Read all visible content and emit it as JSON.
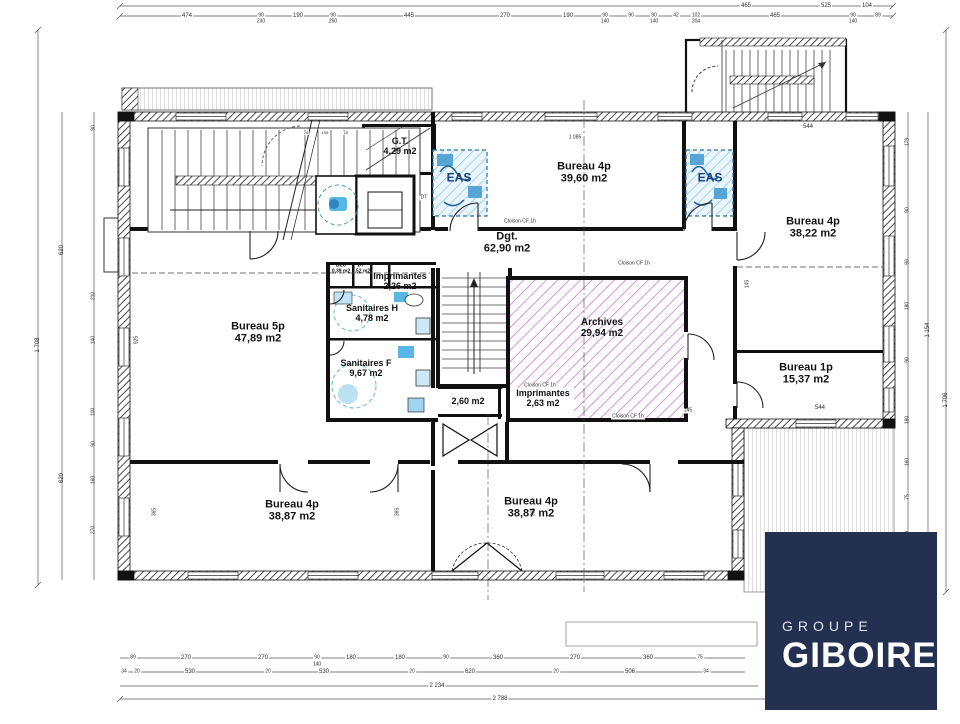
{
  "document": {
    "type": "architectural-floor-plan",
    "level": "etage-bureaux"
  },
  "logo": {
    "line1": "GROUPE",
    "line2": "GIBOIRE",
    "bg_color": "#233050",
    "text_color": "#ffffff"
  },
  "colors": {
    "wall": "#1a1a1a",
    "archives_hatch": "#c873c8",
    "sanitary_blue": "#59b7e3",
    "eas_hatch_blue": "#7cc4e8",
    "eas_text_blue": "#16417c",
    "deck_line": "#aaaaaa"
  },
  "plan": {
    "rooms": [
      {
        "name": "Bureau 5p",
        "area": "47,89 m2",
        "x": 258,
        "y": 333,
        "fs": 11
      },
      {
        "name": "Bureau 4p",
        "area": "39,60 m2",
        "x": 584,
        "y": 173,
        "fs": 11
      },
      {
        "name": "Bureau 4p",
        "area": "38,22 m2",
        "x": 813,
        "y": 228,
        "fs": 11
      },
      {
        "name": "Bureau 1p",
        "area": "15,37 m2",
        "x": 806,
        "y": 374,
        "fs": 11
      },
      {
        "name": "Bureau 4p",
        "area": "38,87 m2",
        "x": 292,
        "y": 511,
        "fs": 11
      },
      {
        "name": "Bureau 4p",
        "area": "38,87 m2",
        "x": 531,
        "y": 508,
        "fs": 11
      },
      {
        "name": "Dgt.",
        "area": "62,90 m2",
        "x": 507,
        "y": 243,
        "fs": 11
      },
      {
        "name": "Archives",
        "area": "29,94 m2",
        "x": 602,
        "y": 328,
        "fs": 10
      },
      {
        "name": "G.T.",
        "area": "4,29 m2",
        "x": 400,
        "y": 146,
        "fs": 9
      },
      {
        "name": "Sanitaires H",
        "area": "4,78 m2",
        "x": 372,
        "y": 313,
        "fs": 9
      },
      {
        "name": "Sanitaires F",
        "area": "9,67 m2",
        "x": 366,
        "y": 368,
        "fs": 9
      },
      {
        "name": "Imprimantes",
        "area": "2,26 m2",
        "x": 400,
        "y": 281,
        "fs": 9
      },
      {
        "name": "Imprimantes",
        "area": "2,63 m2",
        "x": 543,
        "y": 398,
        "fs": 9
      },
      {
        "name": "BEC",
        "area": "0,39 m2",
        "x": 341,
        "y": 269,
        "fs": 5
      },
      {
        "name": "DT",
        "area": "0,52 m2",
        "x": 361,
        "y": 269,
        "fs": 5
      },
      {
        "name": "",
        "area": "2,60 m2",
        "x": 468,
        "y": 401,
        "fs": 9
      },
      {
        "name": "EAS",
        "area": "",
        "x": 459,
        "y": 178,
        "fs": 12,
        "color": "#16417c"
      },
      {
        "name": "EAS",
        "area": "",
        "x": 710,
        "y": 178,
        "fs": 12,
        "color": "#16417c"
      }
    ],
    "annotations": [
      [
        "474",
        187,
        16,
        6
      ],
      [
        "90",
        261,
        16,
        5
      ],
      [
        "190",
        298,
        16,
        6
      ],
      [
        "90",
        333,
        16,
        5
      ],
      [
        "445",
        409,
        16,
        6
      ],
      [
        "270",
        505,
        16,
        6
      ],
      [
        "190",
        568,
        16,
        6
      ],
      [
        "90",
        605,
        16,
        5
      ],
      [
        "90",
        631,
        16,
        5
      ],
      [
        "90",
        654,
        16,
        5
      ],
      [
        "42",
        676,
        16,
        5
      ],
      [
        "102",
        696,
        16,
        5
      ],
      [
        "465",
        775,
        16,
        6
      ],
      [
        "90",
        853,
        16,
        5
      ],
      [
        "89",
        878,
        16,
        5
      ],
      [
        "230",
        261,
        22,
        5
      ],
      [
        "250",
        333,
        22,
        5
      ],
      [
        "140",
        605,
        22,
        5
      ],
      [
        "140",
        654,
        22,
        5
      ],
      [
        "204",
        696,
        22,
        5
      ],
      [
        "140",
        853,
        22,
        5
      ],
      [
        "465",
        746,
        6,
        6
      ],
      [
        "525",
        826,
        6,
        6
      ],
      [
        "104",
        867,
        6,
        6
      ],
      [
        "89",
        133,
        658,
        5
      ],
      [
        "270",
        186,
        658,
        6
      ],
      [
        "270",
        263,
        658,
        6
      ],
      [
        "90",
        317,
        658,
        5
      ],
      [
        "180",
        351,
        658,
        6
      ],
      [
        "180",
        400,
        658,
        6
      ],
      [
        "90",
        446,
        658,
        5
      ],
      [
        "360",
        498,
        658,
        6
      ],
      [
        "270",
        575,
        658,
        6
      ],
      [
        "360",
        648,
        658,
        6
      ],
      [
        "75",
        700,
        658,
        5
      ],
      [
        "140",
        317,
        665,
        5
      ],
      [
        "34",
        124,
        672,
        5
      ],
      [
        "20",
        137,
        672,
        5
      ],
      [
        "530",
        190,
        672,
        6
      ],
      [
        "20",
        268,
        672,
        5
      ],
      [
        "530",
        324,
        672,
        6
      ],
      [
        "20",
        412,
        672,
        5
      ],
      [
        "620",
        470,
        672,
        6
      ],
      [
        "20",
        556,
        672,
        5
      ],
      [
        "506",
        630,
        672,
        6
      ],
      [
        "34",
        706,
        672,
        5
      ],
      [
        "2 234",
        437,
        686,
        6
      ],
      [
        "2 788",
        500,
        699,
        6
      ],
      [
        "1 708",
        38,
        345,
        6,
        -90
      ],
      [
        "620",
        62,
        250,
        6,
        -90
      ],
      [
        "620",
        62,
        478,
        6,
        -90
      ],
      [
        "90",
        94,
        128,
        5,
        -90
      ],
      [
        "210",
        94,
        296,
        5,
        -90
      ],
      [
        "140",
        94,
        340,
        5,
        -90
      ],
      [
        "100",
        94,
        412,
        5,
        -90
      ],
      [
        "90",
        94,
        444,
        5,
        -90
      ],
      [
        "160",
        94,
        480,
        5,
        -90
      ],
      [
        "270",
        94,
        530,
        5,
        -90
      ],
      [
        "179",
        908,
        142,
        5,
        -90
      ],
      [
        "90",
        908,
        210,
        5,
        -90
      ],
      [
        "90",
        908,
        262,
        5,
        -90
      ],
      [
        "180",
        908,
        306,
        5,
        -90
      ],
      [
        "90",
        908,
        360,
        5,
        -90
      ],
      [
        "180",
        908,
        420,
        5,
        -90
      ],
      [
        "160",
        908,
        462,
        5,
        -90
      ],
      [
        "75",
        908,
        497,
        5,
        -90
      ],
      [
        "90",
        908,
        534,
        5,
        -90
      ],
      [
        "180",
        908,
        574,
        5,
        -90
      ],
      [
        "1 154",
        928,
        330,
        6,
        -90
      ],
      [
        "1 706",
        946,
        400,
        6,
        -90
      ],
      [
        "544",
        808,
        127,
        6
      ],
      [
        "544",
        820,
        408,
        6
      ],
      [
        "145",
        688,
        411,
        5
      ],
      [
        "145",
        748,
        284,
        5,
        -90
      ],
      [
        "365",
        155,
        512,
        5,
        -90
      ],
      [
        "365",
        398,
        512,
        5,
        -90
      ],
      [
        "365",
        534,
        512,
        5,
        -90
      ],
      [
        "925",
        137,
        340,
        5,
        -90
      ],
      [
        "1 085",
        575,
        138,
        5
      ],
      [
        "20",
        306,
        133,
        4
      ],
      [
        "155",
        325,
        133,
        4
      ],
      [
        "20",
        346,
        133,
        4
      ],
      [
        "Cloison CF 1h",
        520,
        222,
        5
      ],
      [
        "Cloison CF 1h",
        634,
        264,
        5
      ],
      [
        "Cloison CF 1h",
        540,
        386,
        5
      ],
      [
        "Cloison CF 1h",
        628,
        417,
        5
      ],
      [
        "DT",
        424,
        198,
        5
      ]
    ]
  }
}
